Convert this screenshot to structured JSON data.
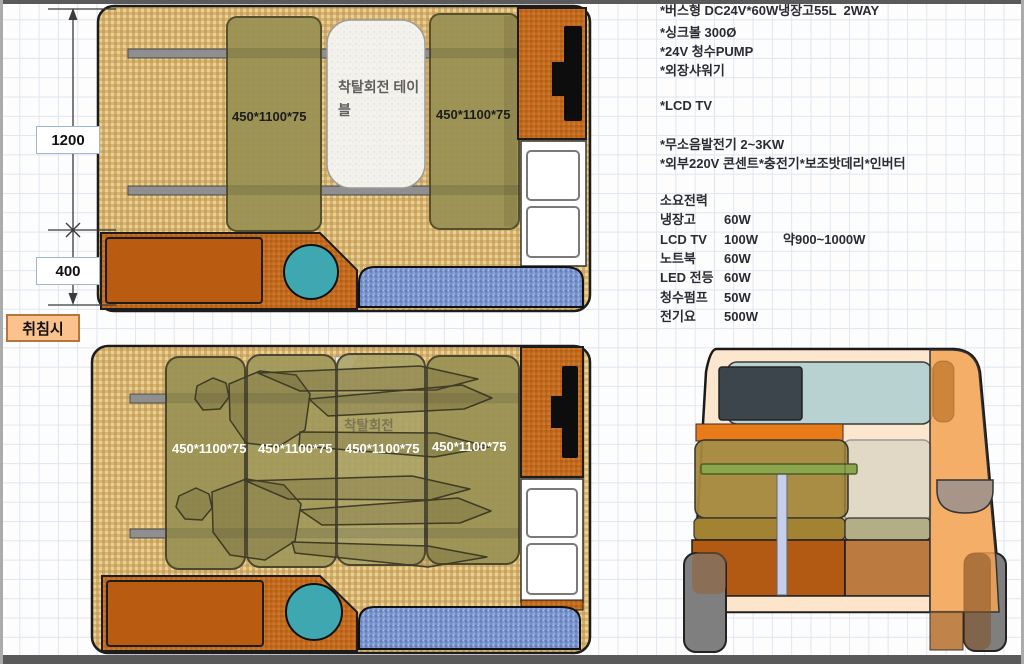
{
  "specs": [
    "*버스형 DC24V*60W냉장고55L  2WAY",
    "*싱크볼 300Ø",
    "*24V 청수PUMP",
    "*외장샤워기",
    "*LCD TV",
    "*무소음발전기 2~3KW",
    "*외부220V 콘센트*충전기*보조밧데리*인버터"
  ],
  "power": {
    "title": "소요전력",
    "total_note": "약900~1000W",
    "rows": [
      {
        "label": "냉장고",
        "value": "60W"
      },
      {
        "label": "LCD TV",
        "value": "100W"
      },
      {
        "label": "노트북",
        "value": "60W"
      },
      {
        "label": "LED 전등",
        "value": "60W"
      },
      {
        "label": "청수펌프",
        "value": "50W"
      },
      {
        "label": "전기요",
        "value": "500W"
      }
    ]
  },
  "dimensions": {
    "upper": "1200",
    "lower": "400"
  },
  "mode_label": "취침시",
  "plan_top": {
    "bench1_label": "450*1100*75",
    "bench2_label": "450*1100*75",
    "table_label": "착탈회전 테이블"
  },
  "plan_bottom": {
    "panel_labels": [
      "450*1100*75",
      "450*1100*75",
      "450*1100*75",
      "450*1100*75"
    ],
    "table_hint": "착탈회전"
  },
  "colors": {
    "floor_tan": "#d9b977",
    "cabinet_orange": "#c1691c",
    "bench_olive": "#9a9254",
    "step_blue": "#7590cb",
    "sink_teal": "#3fa7b0",
    "accent_orange": "#e87a17",
    "van_body_peach": "#fce5cb",
    "window_teal": "#9ccbd3"
  }
}
